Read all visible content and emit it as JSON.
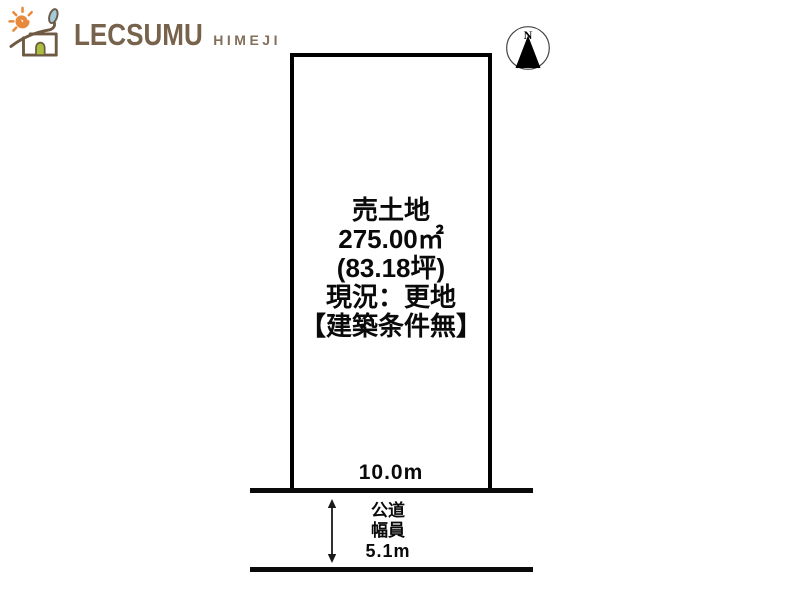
{
  "logo": {
    "brand": "LECSUMU",
    "region": "HIMEJI"
  },
  "compass": {
    "north_label": "N"
  },
  "plot": {
    "title": "売土地",
    "area_sqm": "275.00㎡",
    "area_tsubo": "(83.18坪)",
    "current_status": "現況：更地",
    "building_condition": "【建築条件無】",
    "frontage": "10.0m"
  },
  "road": {
    "type": "公道",
    "width_label": "幅員",
    "width_value": "5.1m"
  },
  "colors": {
    "brand_brown": "#77624c",
    "sun_orange": "#e8893c",
    "leaf_blue": "#a3cbdc",
    "door_green": "#aabf3e",
    "diagram_black": "#0a0a0a"
  }
}
